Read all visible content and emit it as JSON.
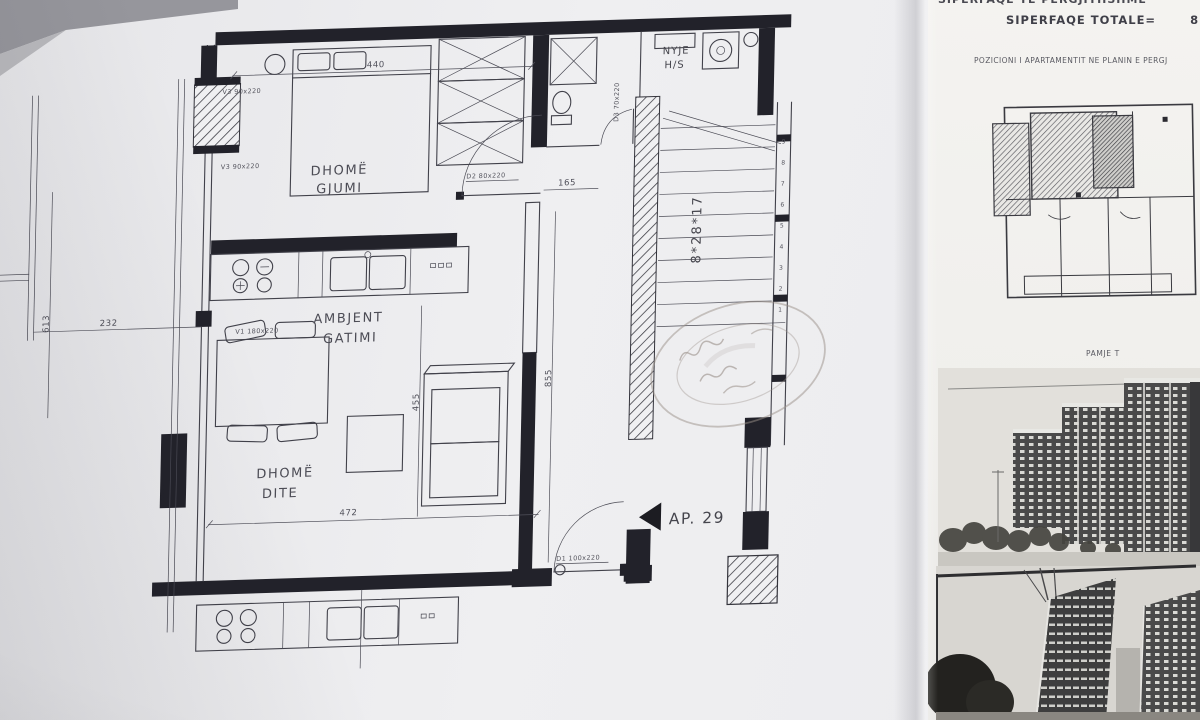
{
  "panel": {
    "clipped_title": "SIPERFAQE TE PERGJITHSHME",
    "total_label": "SIPERFAQE TOTALE=",
    "total_value": "82.4",
    "position_caption": "POZICIONI I APARTAMENTIT NE PLANIN E PERGJ",
    "view_caption": "PAMJE T"
  },
  "plan": {
    "labels": {
      "bedroom1": "DHOMË",
      "bedroom2": "GJUMI",
      "kitchen1": "AMBJENT",
      "kitchen2": "GATIMI",
      "living1": "DHOMË",
      "living2": "DITE",
      "bath1": "NYJE",
      "bath2": "H/S"
    },
    "apartment_label": "AP. 29",
    "stairs": {
      "note": "8*28*17",
      "steps": [
        "1",
        "2",
        "3",
        "4",
        "5",
        "6",
        "7",
        "8",
        "9"
      ]
    },
    "dimensions": {
      "bedroom_width": "440",
      "door_offset": "165",
      "living_width": "472",
      "sofa_line": "455",
      "corridor": "855",
      "balcony_height": "613",
      "balcony_width": "232"
    },
    "windows": {
      "v3_top": "V3  90x220",
      "v3_mid": "V3  90x220",
      "v1": "V1  180x220"
    },
    "doors": {
      "d2": "D2  80x220",
      "d1": "D1  100x220",
      "d3": "D3  70x220"
    }
  },
  "colors": {
    "ink": "#41414a",
    "wall": "#22222a",
    "stamp": "#9a9088",
    "paper_left": "#ebebee",
    "paper_right": "#f3f2ef"
  }
}
